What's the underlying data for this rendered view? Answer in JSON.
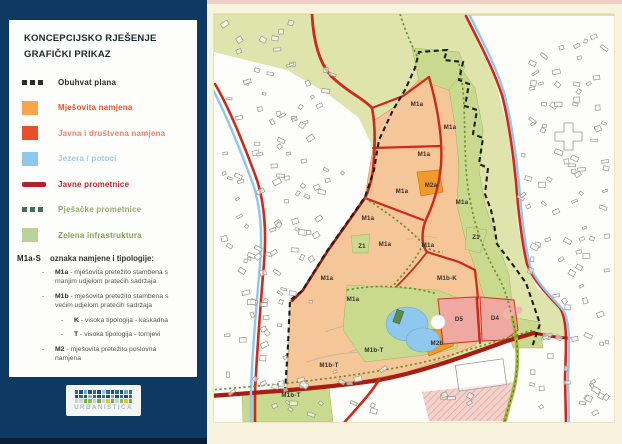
{
  "legend_panel": {
    "title_line1": "KONCEPCIJSKO RJEŠENJE",
    "title_line2": "GRAFIČKI PRIKAZ",
    "items": [
      {
        "id": "obuhvat-plana",
        "label": "Obuhvat plana",
        "swatch": "dashes",
        "color": "#2b2b2b",
        "text_color": "#2b2b2b",
        "bold": true
      },
      {
        "id": "mjesovita-namjena",
        "label": "Mješovita namjena",
        "swatch": "square",
        "color": "#F8A44C",
        "text_color": "#E0572A",
        "bold": true
      },
      {
        "id": "javna-i-drustvena-namjena",
        "label": "Javna i društvena namjena",
        "swatch": "square",
        "color": "#E94F2C",
        "text_color": "#E9826D",
        "bold": true
      },
      {
        "id": "jezera-potoci",
        "label": "Jezera / potoci",
        "swatch": "square",
        "color": "#8FC7EF",
        "text_color": "#99C9EC",
        "bold": true
      },
      {
        "id": "javne-prometnice",
        "label": "Javne prometnice",
        "swatch": "line",
        "color": "#B81F2B",
        "text_color": "#C2242E",
        "bold": true
      },
      {
        "id": "pjesacke-prometnice",
        "label": "Pješačke prometnice",
        "swatch": "dashes",
        "color": "#44705A",
        "text_color": "#93AC71",
        "bold": true
      },
      {
        "id": "zelena-infrastruktura",
        "label": "Zelena infrastruktura",
        "swatch": "square",
        "color": "#BBD39A",
        "text_color": "#7FA356",
        "bold": true
      }
    ],
    "typology": {
      "code": "M1a-S",
      "heading": "oznaka namjene i tipologije:",
      "entries": [
        {
          "code": "M1a",
          "desc": "mješovita pretežito stambena s manjim udjelom pratećih sadržaja",
          "indent": 1
        },
        {
          "code": "M1b",
          "desc": "mješovita pretežito stambena s većim udjelom pratećih sadržaja",
          "indent": 1
        },
        {
          "code": "K",
          "desc": "visoka tipologija - kaskadna",
          "indent": 2
        },
        {
          "code": "T",
          "desc": "visoka tipologija - tornjevi",
          "indent": 2
        },
        {
          "code": "M2",
          "desc": "mješovita pretežito poslovna namjena",
          "indent": 1
        }
      ]
    },
    "logo_text": "URBANISTICA"
  },
  "map": {
    "zone_labels": [
      {
        "text": "M1a",
        "x": 210,
        "y": 106
      },
      {
        "text": "M1a",
        "x": 243,
        "y": 129
      },
      {
        "text": "M1a",
        "x": 217,
        "y": 156
      },
      {
        "text": "M1a",
        "x": 195,
        "y": 193
      },
      {
        "text": "M2a",
        "x": 224,
        "y": 187
      },
      {
        "text": "M1a",
        "x": 255,
        "y": 204
      },
      {
        "text": "M1a",
        "x": 161,
        "y": 220
      },
      {
        "text": "M1a",
        "x": 178,
        "y": 246
      },
      {
        "text": "Z1",
        "x": 155,
        "y": 248
      },
      {
        "text": "M1a",
        "x": 221,
        "y": 247
      },
      {
        "text": "Z1",
        "x": 269,
        "y": 239
      },
      {
        "text": "M1a",
        "x": 120,
        "y": 280
      },
      {
        "text": "M1b-K",
        "x": 240,
        "y": 280
      },
      {
        "text": "M1a",
        "x": 146,
        "y": 301
      },
      {
        "text": "D5",
        "x": 252,
        "y": 321
      },
      {
        "text": "D4",
        "x": 288,
        "y": 320
      },
      {
        "text": "M2b",
        "x": 230,
        "y": 345
      },
      {
        "text": "M1b-T",
        "x": 167,
        "y": 352
      },
      {
        "text": "M1b-T",
        "x": 122,
        "y": 367
      },
      {
        "text": "M1b-T",
        "x": 84,
        "y": 397
      }
    ]
  },
  "colors": {
    "panel_navy": "#0E3963",
    "page_cream": "#F8F3DD",
    "map_base": "#DFE3AC",
    "green_infra": "#C9DA8F",
    "zone_orange": "#F5C697",
    "zone_orange_dark": "#F09A2C",
    "zone_pink": "#F0A8A2",
    "water": "#8FC7EF",
    "road_red": "#CE2A1C",
    "road_dark": "#A81D12",
    "path_green": "#6E8F2F",
    "route_green": "#9CB83C",
    "boundary_black": "#1d1d1d"
  }
}
